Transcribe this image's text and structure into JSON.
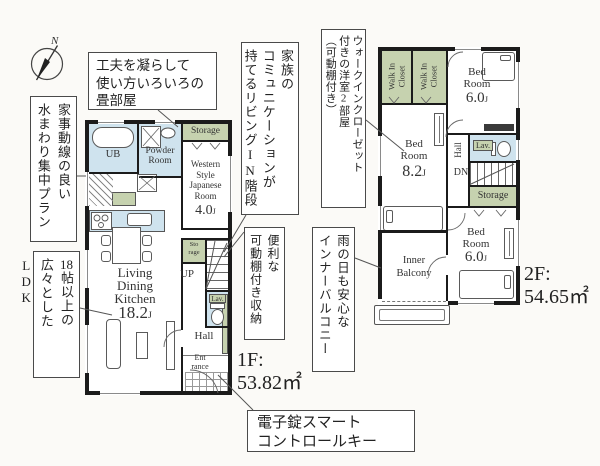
{
  "palette": {
    "bg": "#fbfaf7",
    "wall": "#1b1b1b",
    "wet": "#cfe3ee",
    "green": "#c6d2af",
    "text": "#333333",
    "callout_border": "#4a4a4a",
    "line": "#555555"
  },
  "compass": {
    "label": "N"
  },
  "callouts": {
    "tatami": {
      "line1": "工夫を凝らして",
      "line2": "使い方いろいろの",
      "line3": "畳部屋"
    },
    "mizumawari": {
      "col1": "家事動線の良い",
      "col2": "水まわり集中プラン"
    },
    "ldk_wide": {
      "col1_num": "18",
      "col1_rest": "帖以上の",
      "col2": "広々としたLDK"
    },
    "living_in_stairs": {
      "col1": "家族の",
      "col2": "コミュニケーションが",
      "col3": "持てるリビングIN階段"
    },
    "movable_shelf": {
      "col1": "便利な",
      "col2": "可動棚付き収納"
    },
    "wic_note": {
      "col1": "ウォークインクローゼット",
      "col2": "付きの洋室2部屋",
      "col3": "（可動棚付き）"
    },
    "inner_balcony_note": {
      "col1": "雨の日も安心な",
      "col2": "インナーバルコニー"
    },
    "smart_key": {
      "line1": "電子錠スマート",
      "line2": "コントロールキー"
    }
  },
  "floor1": {
    "title": "1F:",
    "area": "53.82㎡",
    "ub": "UB",
    "powder_line1": "Powder",
    "powder_line2": "Room",
    "storage": "Storage",
    "wsjr_line1": "Western",
    "wsjr_line2": "Style",
    "wsjr_line3": "Japanese",
    "wsjr_line4": "Room",
    "wsjr_size": "4.0",
    "ldk_line1": "Living",
    "ldk_line2": "Dining",
    "ldk_line3": "Kitchen",
    "ldk_size": "18.2",
    "storage2_line1": "Sto",
    "storage2_line2": "rage",
    "up": "UP",
    "lav": "Lav.",
    "hall": "Hall",
    "entrance_line1": "Ent",
    "entrance_line2": "rance",
    "unit": "J"
  },
  "floor2": {
    "title": "2F:",
    "area": "54.65㎡",
    "wic_line1": "Walk In",
    "wic_line2": "Closet",
    "bed_line1": "Bed",
    "bed_line2": "Room",
    "bed1_size": "6.0",
    "bed2_size": "8.2",
    "bed3_size": "6.0",
    "hall": "Hall",
    "dn": "DN",
    "lav": "Lav.",
    "storage": "Storage",
    "balcony_line1": "Inner",
    "balcony_line2": "Balcony",
    "unit": "J"
  }
}
